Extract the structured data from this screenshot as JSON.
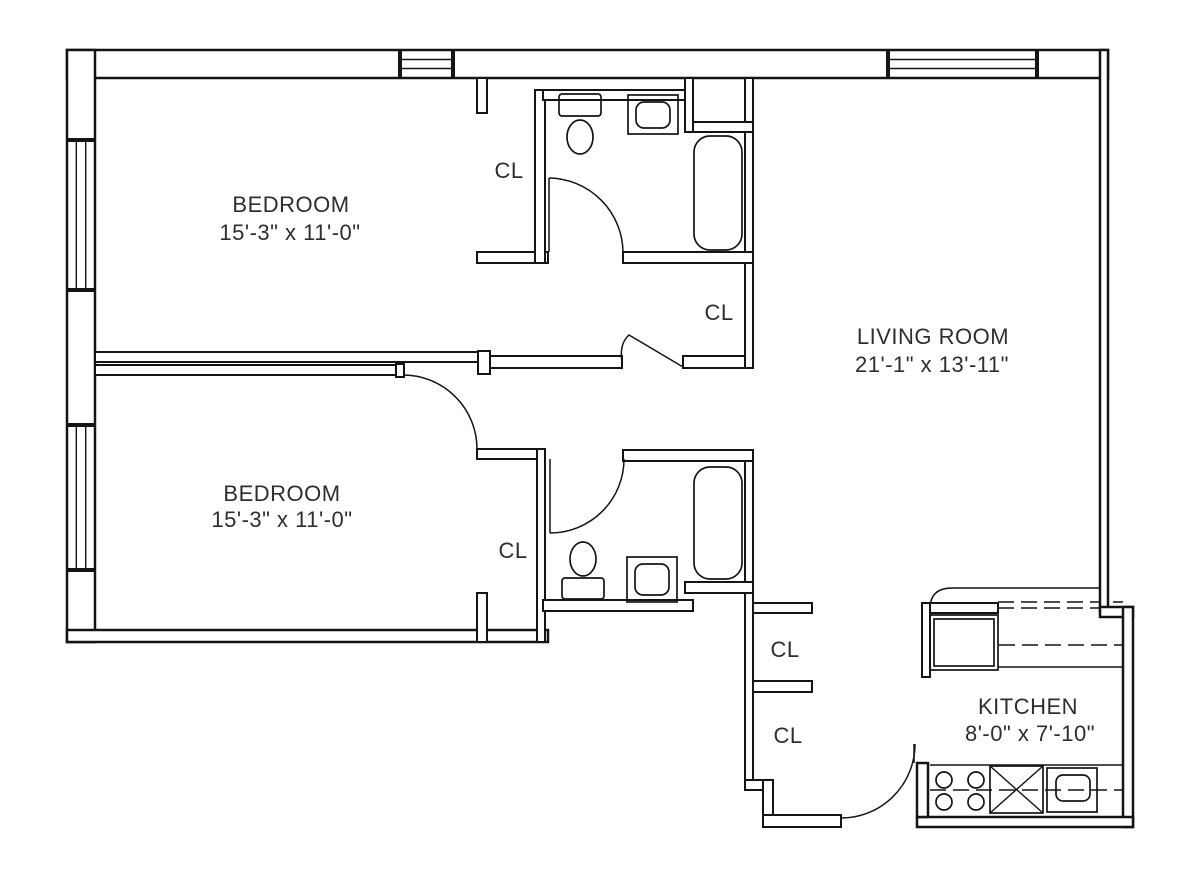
{
  "colors": {
    "line": "#141414",
    "background": "#ffffff",
    "text": "#2e2e2e"
  },
  "rooms": {
    "bedroom_top": {
      "name": "BEDROOM",
      "dims": "15'-3\" x 11'-0\""
    },
    "bedroom_bottom": {
      "name": "BEDROOM",
      "dims": "15'-3\" x 11'-0\""
    },
    "living_room": {
      "name": "LIVING ROOM",
      "dims": "21'-1\" x 13'-11\""
    },
    "kitchen": {
      "name": "KITCHEN",
      "dims": "8'-0\" x 7'-10\""
    }
  },
  "closets": [
    {
      "label": "CL",
      "location": "bedroom-top-closet"
    },
    {
      "label": "CL",
      "location": "hall-closet-below-bathroom"
    },
    {
      "label": "CL",
      "location": "bedroom-bottom-closet"
    },
    {
      "label": "CL",
      "location": "foyer-closet-upper"
    },
    {
      "label": "CL",
      "location": "foyer-closet-lower"
    }
  ]
}
